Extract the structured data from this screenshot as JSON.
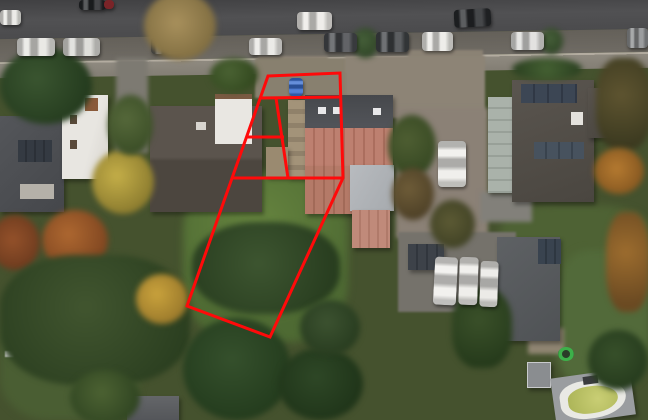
{
  "meta": {
    "description": "Aerial drone photograph of a suburban street in autumn with a red property/plot boundary overlay drawn over one parcel",
    "season": "autumn",
    "view": "top-down aerial"
  },
  "palette": {
    "boundary_red": "#ff0a0a",
    "asphalt": "#4b4b4d",
    "shoulder": "#6f6b64",
    "sidewalk": "#8f8a80",
    "grass_light": "#5f7d3e",
    "grass_dark": "#3a4f2c",
    "roof_dark_gray": "#4e5054",
    "roof_brown_gray": "#57504a",
    "roof_terracotta": "#b97a66",
    "roof_light_gray": "#b3b6ba",
    "house_white": "#e8e6e1",
    "driveway_tan": "#8d8476",
    "van_white": "#f0efec",
    "car_blue": "#3a6ed0",
    "pool_rim_white": "#e9e9e4",
    "pool_water": "#c2c768"
  },
  "boundary": {
    "color": "#ff0a0a",
    "stroke_width": 3,
    "outer_polygon": "268,76 340,73 343,178 270,337 187,306",
    "inner_segments": [
      "260,98 342,97",
      "276,98 288,178",
      "246,137 284,137",
      "233,178 343,178"
    ],
    "parcel_count": 5
  },
  "scene_inventory": {
    "street_position": "horizontal band across top",
    "moving_cars_on_road": 2,
    "parked_cars_lower_side": 9,
    "parked_cars_upper_side": 2,
    "blue_car_in_plot_driveway": 1,
    "white_vans_rear_parking": 3,
    "white_van_right_driveway": 1,
    "houses_with_dark_roofs": 4,
    "house_with_terracotta_roof_inside_plot": 1,
    "solar_panel_arrays": 3,
    "greenhouse_structure": 1,
    "swimming_pool_bottom_right": 1,
    "trampoline": 1,
    "large_lawn_inside_plot": 1,
    "autumn_trees": "many (yellow, orange, dark green)"
  }
}
